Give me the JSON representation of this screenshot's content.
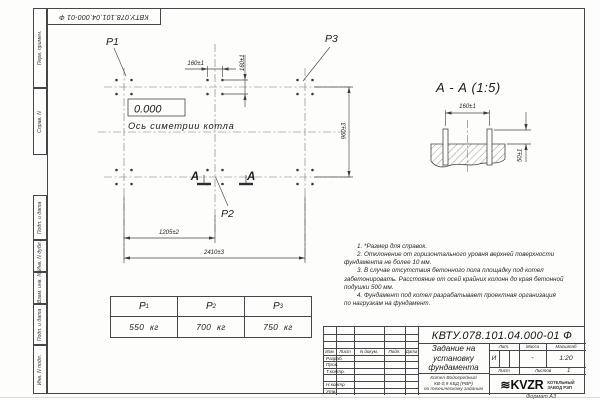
{
  "colors": {
    "ink": "#45454a",
    "paper": "#fdfdfb"
  },
  "corner_stamp": {
    "doc_number": "КВТУ.078.101.04.000-01 Ф"
  },
  "margin_strip": {
    "labels": [
      "Перв. примен.",
      "Справ. N",
      "Подп. и дата",
      "Инв. N дубл.",
      "Взам. инв. N",
      "Подп. и дата",
      "Инв. N подл."
    ]
  },
  "plan": {
    "point_labels": {
      "p1": "P1",
      "p2": "P2",
      "p3": "P3"
    },
    "level_mark": "0.000",
    "axis_label": "Ось симетрии котла",
    "section_letter": "А",
    "dim_160h": "160±1",
    "dim_160v": "160±1",
    "dim_960": "960±3",
    "dim_1205": "1205±2",
    "dim_2410": "2410±3"
  },
  "section_view": {
    "title": "А - А (1:5)",
    "dim_width": "160±1",
    "dim_height": "50±1"
  },
  "notes": {
    "lines": [
      {
        "text": "1. *Размер для справок.",
        "indent": true
      },
      {
        "text": "2. Отклонение от горизонтального уровня верхней поверхности",
        "indent": true
      },
      {
        "text": "фундамента не более 10 мм.",
        "indent": false
      },
      {
        "text": "3. В случае отсутствия бетонного пола площадку под котел",
        "indent": true
      },
      {
        "text": "забетонировать. Расстояние от осей крайних колонн до края бетонной",
        "indent": false
      },
      {
        "text": "подушки 500 мм.",
        "indent": false
      },
      {
        "text": "4. Фундамент под котел разрабатывает проектная организация",
        "indent": true
      },
      {
        "text": "по нагрузкам на фундамент.",
        "indent": false
      }
    ]
  },
  "load_table": {
    "columns": [
      {
        "symbol": "P",
        "sub": "1",
        "value": "550 кг"
      },
      {
        "symbol": "P",
        "sub": "2",
        "value": "700 кг"
      },
      {
        "symbol": "P",
        "sub": "3",
        "value": "750 кг"
      }
    ]
  },
  "title_block": {
    "doc_number": "КВТУ.078.101.04.000-01 Ф",
    "title_lines": [
      "Задание на",
      "установку",
      "фундамента"
    ],
    "product_lines": [
      "Котел Водогрейный",
      "КВ-0,9 КБД (РВР)",
      "по техническому заданию"
    ],
    "approval_header": [
      "Изм.",
      "Лист",
      "N докум.",
      "Подп.",
      "Дата"
    ],
    "approval_rows": [
      "Разраб.",
      "Пров.",
      "Т.контр.",
      "",
      "Н.контр.",
      "Утв."
    ],
    "lit_label": "Лит.",
    "mass_label": "Масса",
    "scale_label": "Масштаб",
    "lit_value": "И",
    "mass_value": "-",
    "scale_value": "1:20",
    "sheet_label": "Лист",
    "sheets_label": "Листов",
    "sheets_value": "1",
    "logo_text": "KVZR",
    "logo_caption": [
      "КОТЕЛЬНЫЙ",
      "ЗАВОД РЭП"
    ],
    "format_label": "Формат А3"
  }
}
